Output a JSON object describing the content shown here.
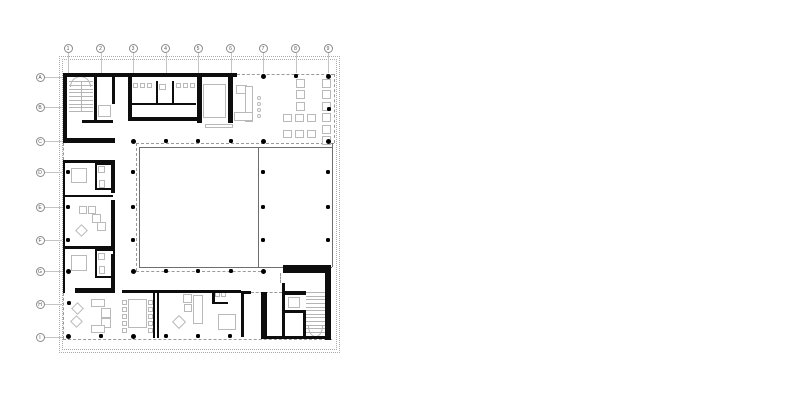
{
  "canvas": {
    "width": 800,
    "height": 416,
    "background": "#ffffff"
  },
  "colors": {
    "wall": "#0d0d0d",
    "furniture": "#b9b9b9",
    "thin": "#6e6e6e",
    "dashed": "#9a9a9a",
    "site": "#aaaaaa",
    "grid": "#c4c4c4",
    "bubble_border": "#8a8a8a",
    "bubble_text": "#555555",
    "dot": "#000000",
    "stair": "#b5b5b5"
  },
  "grid": {
    "columns": {
      "labels": [
        "1",
        "2",
        "3",
        "4",
        "5",
        "6",
        "7",
        "8",
        "9"
      ],
      "x": [
        68,
        100.5,
        133,
        165.5,
        198,
        230.5,
        263,
        295.5,
        328
      ],
      "bubble_cy": 48,
      "leader_y1": 53,
      "leader_y2": 73
    },
    "rows": {
      "labels": [
        "A",
        "B",
        "C",
        "D",
        "E",
        "F",
        "G",
        "H",
        "I"
      ],
      "y": [
        77,
        107,
        141,
        172,
        207,
        240,
        271,
        304,
        337
      ],
      "bubble_cx": 40,
      "leader_x1": 45,
      "leader_x2": 62
    }
  },
  "site_boundaries": [
    [
      59,
      56,
      281,
      297
    ],
    [
      62,
      59,
      275,
      291
    ]
  ],
  "walls": [
    [
      63,
      73,
      174,
      4
    ],
    [
      63,
      73,
      4,
      70
    ],
    [
      63,
      138,
      52,
      5
    ],
    [
      94,
      73,
      3,
      50
    ],
    [
      112,
      77,
      3,
      27
    ],
    [
      82,
      120,
      31,
      3
    ],
    [
      128,
      77,
      4,
      44
    ],
    [
      128,
      117,
      70,
      4
    ],
    [
      130,
      103,
      66,
      2
    ],
    [
      156,
      81,
      2,
      22
    ],
    [
      172,
      81,
      2,
      22
    ],
    [
      197,
      77,
      5,
      46
    ],
    [
      228,
      77,
      5,
      46
    ],
    [
      63,
      160,
      52,
      3
    ],
    [
      63,
      160,
      2,
      133
    ],
    [
      111,
      163,
      4,
      30
    ],
    [
      111,
      200,
      4,
      47
    ],
    [
      111,
      254,
      4,
      39
    ],
    [
      63,
      195,
      50,
      2
    ],
    [
      63,
      246,
      52,
      3
    ],
    [
      75,
      288,
      40,
      5
    ],
    [
      122,
      290,
      119,
      3
    ],
    [
      153,
      292,
      2,
      46
    ],
    [
      157,
      292,
      2,
      46
    ],
    [
      212,
      290,
      3,
      14
    ],
    [
      212,
      302,
      16,
      2
    ],
    [
      241,
      291,
      10,
      3
    ],
    [
      241,
      292,
      3,
      45
    ],
    [
      261,
      292,
      6,
      46
    ],
    [
      283,
      265,
      47,
      8
    ],
    [
      325,
      265,
      6,
      75
    ],
    [
      282,
      283,
      3,
      55
    ],
    [
      285,
      291,
      21,
      4
    ],
    [
      285,
      310,
      21,
      3
    ],
    [
      303,
      310,
      3,
      28
    ],
    [
      261,
      336,
      70,
      3
    ]
  ],
  "bath_boxes": [
    [
      95,
      163,
      20,
      27
    ],
    [
      95,
      249,
      20,
      29
    ]
  ],
  "thin_lines": [
    [
      139,
      147,
      332,
      147
    ],
    [
      139,
      147,
      139,
      267
    ],
    [
      139,
      267,
      332,
      267
    ],
    [
      258,
      147,
      258,
      267
    ],
    [
      332,
      143,
      332,
      267
    ]
  ],
  "dashed_lines": [
    [
      237,
      74,
      334,
      74
    ],
    [
      334,
      74,
      334,
      143
    ],
    [
      136,
      143,
      334,
      143
    ],
    [
      136,
      143,
      136,
      271
    ],
    [
      136,
      271,
      261,
      271
    ],
    [
      63,
      143,
      63,
      160
    ],
    [
      63,
      293,
      63,
      339
    ],
    [
      63,
      339,
      332,
      339
    ],
    [
      251,
      292,
      282,
      292
    ],
    [
      280,
      273,
      280,
      283
    ],
    [
      115,
      74,
      128,
      74
    ]
  ],
  "columns_large": [
    [
      263,
      76
    ],
    [
      328,
      76
    ],
    [
      133,
      141
    ],
    [
      263,
      141
    ],
    [
      328,
      141
    ],
    [
      68,
      271
    ],
    [
      133,
      271
    ],
    [
      263,
      271
    ],
    [
      68,
      336
    ],
    [
      133,
      336
    ]
  ],
  "columns_small": [
    [
      296,
      76
    ],
    [
      329,
      109
    ],
    [
      166,
      141
    ],
    [
      198,
      141
    ],
    [
      231,
      141
    ],
    [
      68,
      172
    ],
    [
      133,
      172
    ],
    [
      263,
      172
    ],
    [
      328,
      172
    ],
    [
      68,
      207
    ],
    [
      133,
      207
    ],
    [
      263,
      207
    ],
    [
      328,
      207
    ],
    [
      68,
      240
    ],
    [
      133,
      240
    ],
    [
      263,
      240
    ],
    [
      328,
      240
    ],
    [
      166,
      271
    ],
    [
      198,
      271
    ],
    [
      231,
      271
    ],
    [
      69,
      303
    ],
    [
      101,
      336
    ],
    [
      166,
      336
    ],
    [
      198,
      336
    ],
    [
      230,
      336
    ]
  ],
  "furniture_rects": [
    [
      133,
      83,
      5,
      5
    ],
    [
      140,
      83,
      5,
      5
    ],
    [
      147,
      83,
      5,
      5
    ],
    [
      176,
      83,
      5,
      5
    ],
    [
      183,
      83,
      5,
      5
    ],
    [
      190,
      83,
      5,
      5
    ],
    [
      159,
      84,
      7,
      6
    ],
    [
      98,
      105,
      13,
      12
    ],
    [
      203,
      84,
      23,
      34
    ],
    [
      205,
      124,
      28,
      4
    ],
    [
      236,
      85,
      11,
      9
    ],
    [
      245,
      86,
      8,
      36
    ],
    [
      234,
      112,
      19,
      9
    ],
    [
      296,
      79,
      9,
      9
    ],
    [
      296,
      90,
      9,
      9
    ],
    [
      296,
      102,
      9,
      9
    ],
    [
      322,
      79,
      9,
      9
    ],
    [
      322,
      90,
      9,
      9
    ],
    [
      322,
      102,
      9,
      9
    ],
    [
      322,
      113,
      9,
      9
    ],
    [
      322,
      125,
      9,
      9
    ],
    [
      322,
      136,
      9,
      9
    ],
    [
      283,
      114,
      9,
      8
    ],
    [
      295,
      114,
      9,
      8
    ],
    [
      307,
      114,
      9,
      8
    ],
    [
      283,
      130,
      9,
      8
    ],
    [
      295,
      130,
      9,
      8
    ],
    [
      307,
      130,
      9,
      8
    ],
    [
      71,
      168,
      16,
      15
    ],
    [
      98,
      166,
      7,
      7
    ],
    [
      99,
      180,
      6,
      8
    ],
    [
      79,
      206,
      8,
      8
    ],
    [
      88,
      206,
      8,
      8
    ],
    [
      92,
      214,
      9,
      9
    ],
    [
      97,
      222,
      9,
      9
    ],
    [
      71,
      255,
      16,
      16
    ],
    [
      98,
      253,
      7,
      7
    ],
    [
      99,
      266,
      6,
      8
    ],
    [
      91,
      299,
      14,
      8
    ],
    [
      101,
      308,
      10,
      10
    ],
    [
      101,
      318,
      10,
      10
    ],
    [
      91,
      325,
      14,
      8
    ],
    [
      128,
      299,
      19,
      29
    ],
    [
      122,
      300,
      5,
      5
    ],
    [
      122,
      307,
      5,
      5
    ],
    [
      122,
      314,
      5,
      5
    ],
    [
      122,
      321,
      5,
      5
    ],
    [
      122,
      328,
      5,
      5
    ],
    [
      148,
      300,
      5,
      5
    ],
    [
      148,
      307,
      5,
      5
    ],
    [
      148,
      314,
      5,
      5
    ],
    [
      148,
      321,
      5,
      5
    ],
    [
      148,
      328,
      5,
      5
    ],
    [
      183,
      294,
      9,
      9
    ],
    [
      184,
      304,
      8,
      8
    ],
    [
      193,
      295,
      10,
      29
    ],
    [
      215,
      292,
      5,
      5
    ],
    [
      221,
      292,
      5,
      5
    ],
    [
      218,
      314,
      18,
      16
    ],
    [
      288,
      297,
      12,
      11
    ]
  ],
  "furniture_diamonds": [
    [
      81,
      230,
      9
    ],
    [
      77,
      308,
      9
    ],
    [
      76,
      321,
      9
    ],
    [
      179,
      322,
      10
    ]
  ],
  "furniture_circles": [
    [
      259,
      98,
      4
    ],
    [
      259,
      104,
      4
    ],
    [
      259,
      110,
      4
    ],
    [
      259,
      116,
      4
    ]
  ],
  "stairs": [
    {
      "x": 68.5,
      "y": 81,
      "w": 24,
      "h": 30,
      "treads": 9,
      "divider": true,
      "arc": "top",
      "arc_rect": [
        70,
        76,
        21,
        11
      ]
    },
    {
      "x": 306,
      "y": 292,
      "w": 19,
      "h": 40,
      "treads": 12,
      "divider": false,
      "arc": "bottom",
      "arc_rect": [
        308,
        326,
        15,
        11
      ]
    }
  ]
}
